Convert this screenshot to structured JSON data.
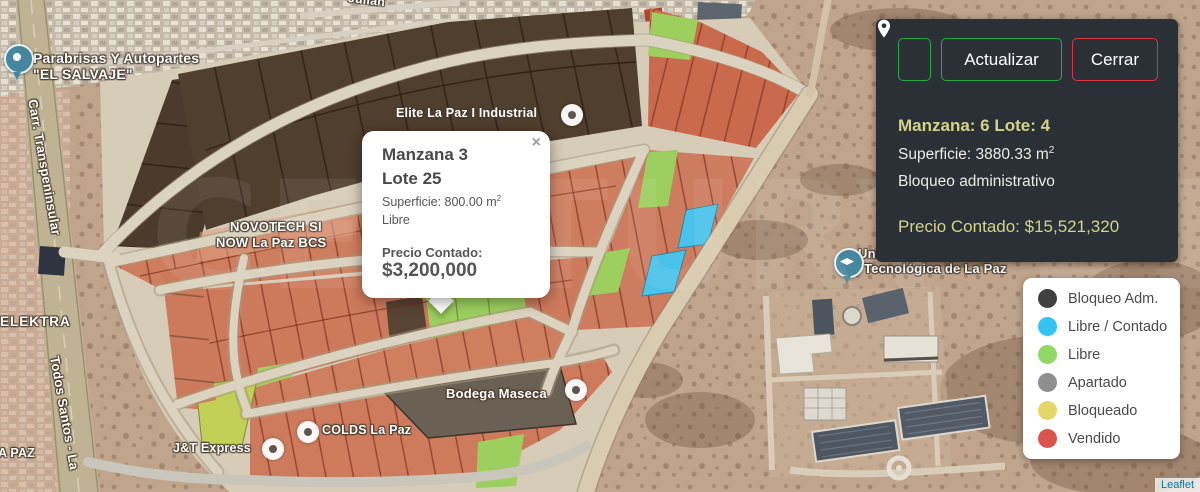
{
  "map": {
    "labels": {
      "julian": "Julián",
      "parabrisas_1": "Parabrisas Y Autopartes",
      "parabrisas_2": "\"EL SALVAJE\"",
      "carretera": "Carr. Transpeninsular",
      "elektra": "ELEKTRA",
      "todos_santos": "Todos Santos - La",
      "la_paz": "A PAZ",
      "elite": "Elite La Paz I Industrial",
      "novotech_1": "NOVOTECH SI",
      "novotech_2": "NOW La Paz BCS",
      "bodega": "Bodega Maseca",
      "colds": "COLDS La Paz",
      "jt": "J&T Express",
      "universidad_1": "Universidad",
      "universidad_2": "Tecnológica de La Paz"
    },
    "watermark": "CENTURY 21",
    "attribution": "Leaflet"
  },
  "popup": {
    "close": "×",
    "title_line1": "Manzana 3",
    "title_line2": "Lote 25",
    "superficie_text": "Superficie: 800.00 m",
    "superficie_sup": "2",
    "status": "Libre",
    "price_label": "Precio Contado:",
    "price_value": "$3,200,000"
  },
  "panel": {
    "update_button": "Actualizar",
    "close_button": "Cerrar",
    "title": "Manzana: 6 Lote: 4",
    "superficie_text": "Superficie: 3880.33 m",
    "superficie_sup": "2",
    "status": "Bloqueo administrativo",
    "price": "Precio Contado: $15,521,320"
  },
  "legend": {
    "items": [
      {
        "label": "Bloqueo Adm.",
        "color": "#404040"
      },
      {
        "label": "Libre / Contado",
        "color": "#35c3f2"
      },
      {
        "label": "Libre",
        "color": "#8fd964"
      },
      {
        "label": "Apartado",
        "color": "#8f8f8f"
      },
      {
        "label": "Bloqueado",
        "color": "#e3d76a"
      },
      {
        "label": "Vendido",
        "color": "#d9544d"
      }
    ]
  },
  "colors": {
    "panel_bg": "#2b3036",
    "button_green": "#28a745",
    "button_red": "#dc3545",
    "panel_highlight": "#d3d388",
    "lot_sold": "#cd7c5f",
    "lot_free": "#9ccf5e",
    "lot_free_contado": "#49c3ea",
    "lot_blocked_admin": "#503e2e"
  }
}
